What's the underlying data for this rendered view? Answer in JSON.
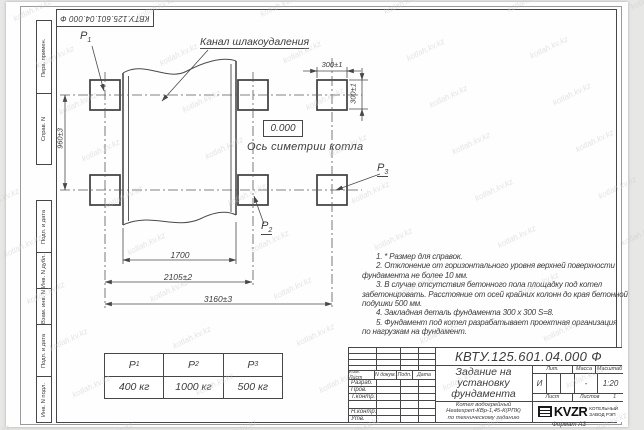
{
  "watermark": {
    "text": "kotlah.kv.kz"
  },
  "stamp_top": {
    "doc_number": "КВТУ.125.601.04.000 Ф"
  },
  "margin": {
    "items": [
      {
        "label": "Перв. примен."
      },
      {
        "label": "Справ. N"
      },
      {
        "label": "Подп. и дата"
      },
      {
        "label": "Инв. N дубл."
      },
      {
        "label": "Взам. инв. N"
      },
      {
        "label": "Подп. и дата"
      },
      {
        "label": "Инв. N подл."
      }
    ]
  },
  "drawing": {
    "channel_label": "Канал шлакоудаления",
    "axis_label": "Ось симетрии котла",
    "elevation": "0.000",
    "markers": {
      "p1": {
        "name": "P",
        "sub": "1"
      },
      "p2": {
        "name": "P",
        "sub": "2"
      },
      "p3": {
        "name": "P",
        "sub": "3"
      }
    },
    "dimensions": {
      "v960": "960±3",
      "t300": "300±1",
      "r300": "300±1",
      "d1700": "1700",
      "d2105": "2105±2",
      "d3160": "3160±3"
    }
  },
  "notes": {
    "lines": [
      "1. * Размер для справок.",
      "2. Отклонение от горизонтального уровня верхней поверхности",
      "фундамента не более 10 мм.",
      "3. В случае отсутствия бетонного пола площадку под котел",
      "забетонировать. Расстояние от осей крайних колонн до края бетонной",
      "подушки 500 мм.",
      "4. Закладная деталь фундамента  300 x 300 S=8.",
      "5. Фундамент под котел разрабатывает проектная организация",
      "по нагрузкам на фундамент."
    ]
  },
  "load_table": {
    "symbol": "P",
    "cols": [
      {
        "sub": "1",
        "value": "400 кг"
      },
      {
        "sub": "2",
        "value": "1000 кг"
      },
      {
        "sub": "3",
        "value": "500 кг"
      }
    ]
  },
  "title_block": {
    "doc_number": "КВТУ.125.601.04.000 Ф",
    "title": "Задание на установку фундамента",
    "subtitle_lines": [
      "Котел водогрейный",
      "Heatexpert-КВр-1,45-К(РПК)",
      "по техническому заданию"
    ],
    "header_cols": {
      "izm": "Изм. Лист",
      "ndoc": "N докум.",
      "podp": "Подп.",
      "data": "Дата"
    },
    "rows": {
      "razrab": "Разраб.",
      "prov": "Пров.",
      "tkontr": "Т.контр.",
      "nkontr": "Н.контр.",
      "utv": "Утв."
    },
    "lit_label": "Лит.",
    "massa_label": "Масса",
    "masshtab_label": "Масштаб",
    "lit_value": "И",
    "massa_value": "-",
    "masshtab_value": "1:20",
    "list_label": "Лист",
    "listov_label": "Листов",
    "listov_value": "1",
    "org": {
      "logo": "KVZR",
      "line1": "КОТЕЛЬНЫЙ",
      "line2": "ЗАВОД РЭП"
    },
    "format_label": "Формат А3"
  }
}
